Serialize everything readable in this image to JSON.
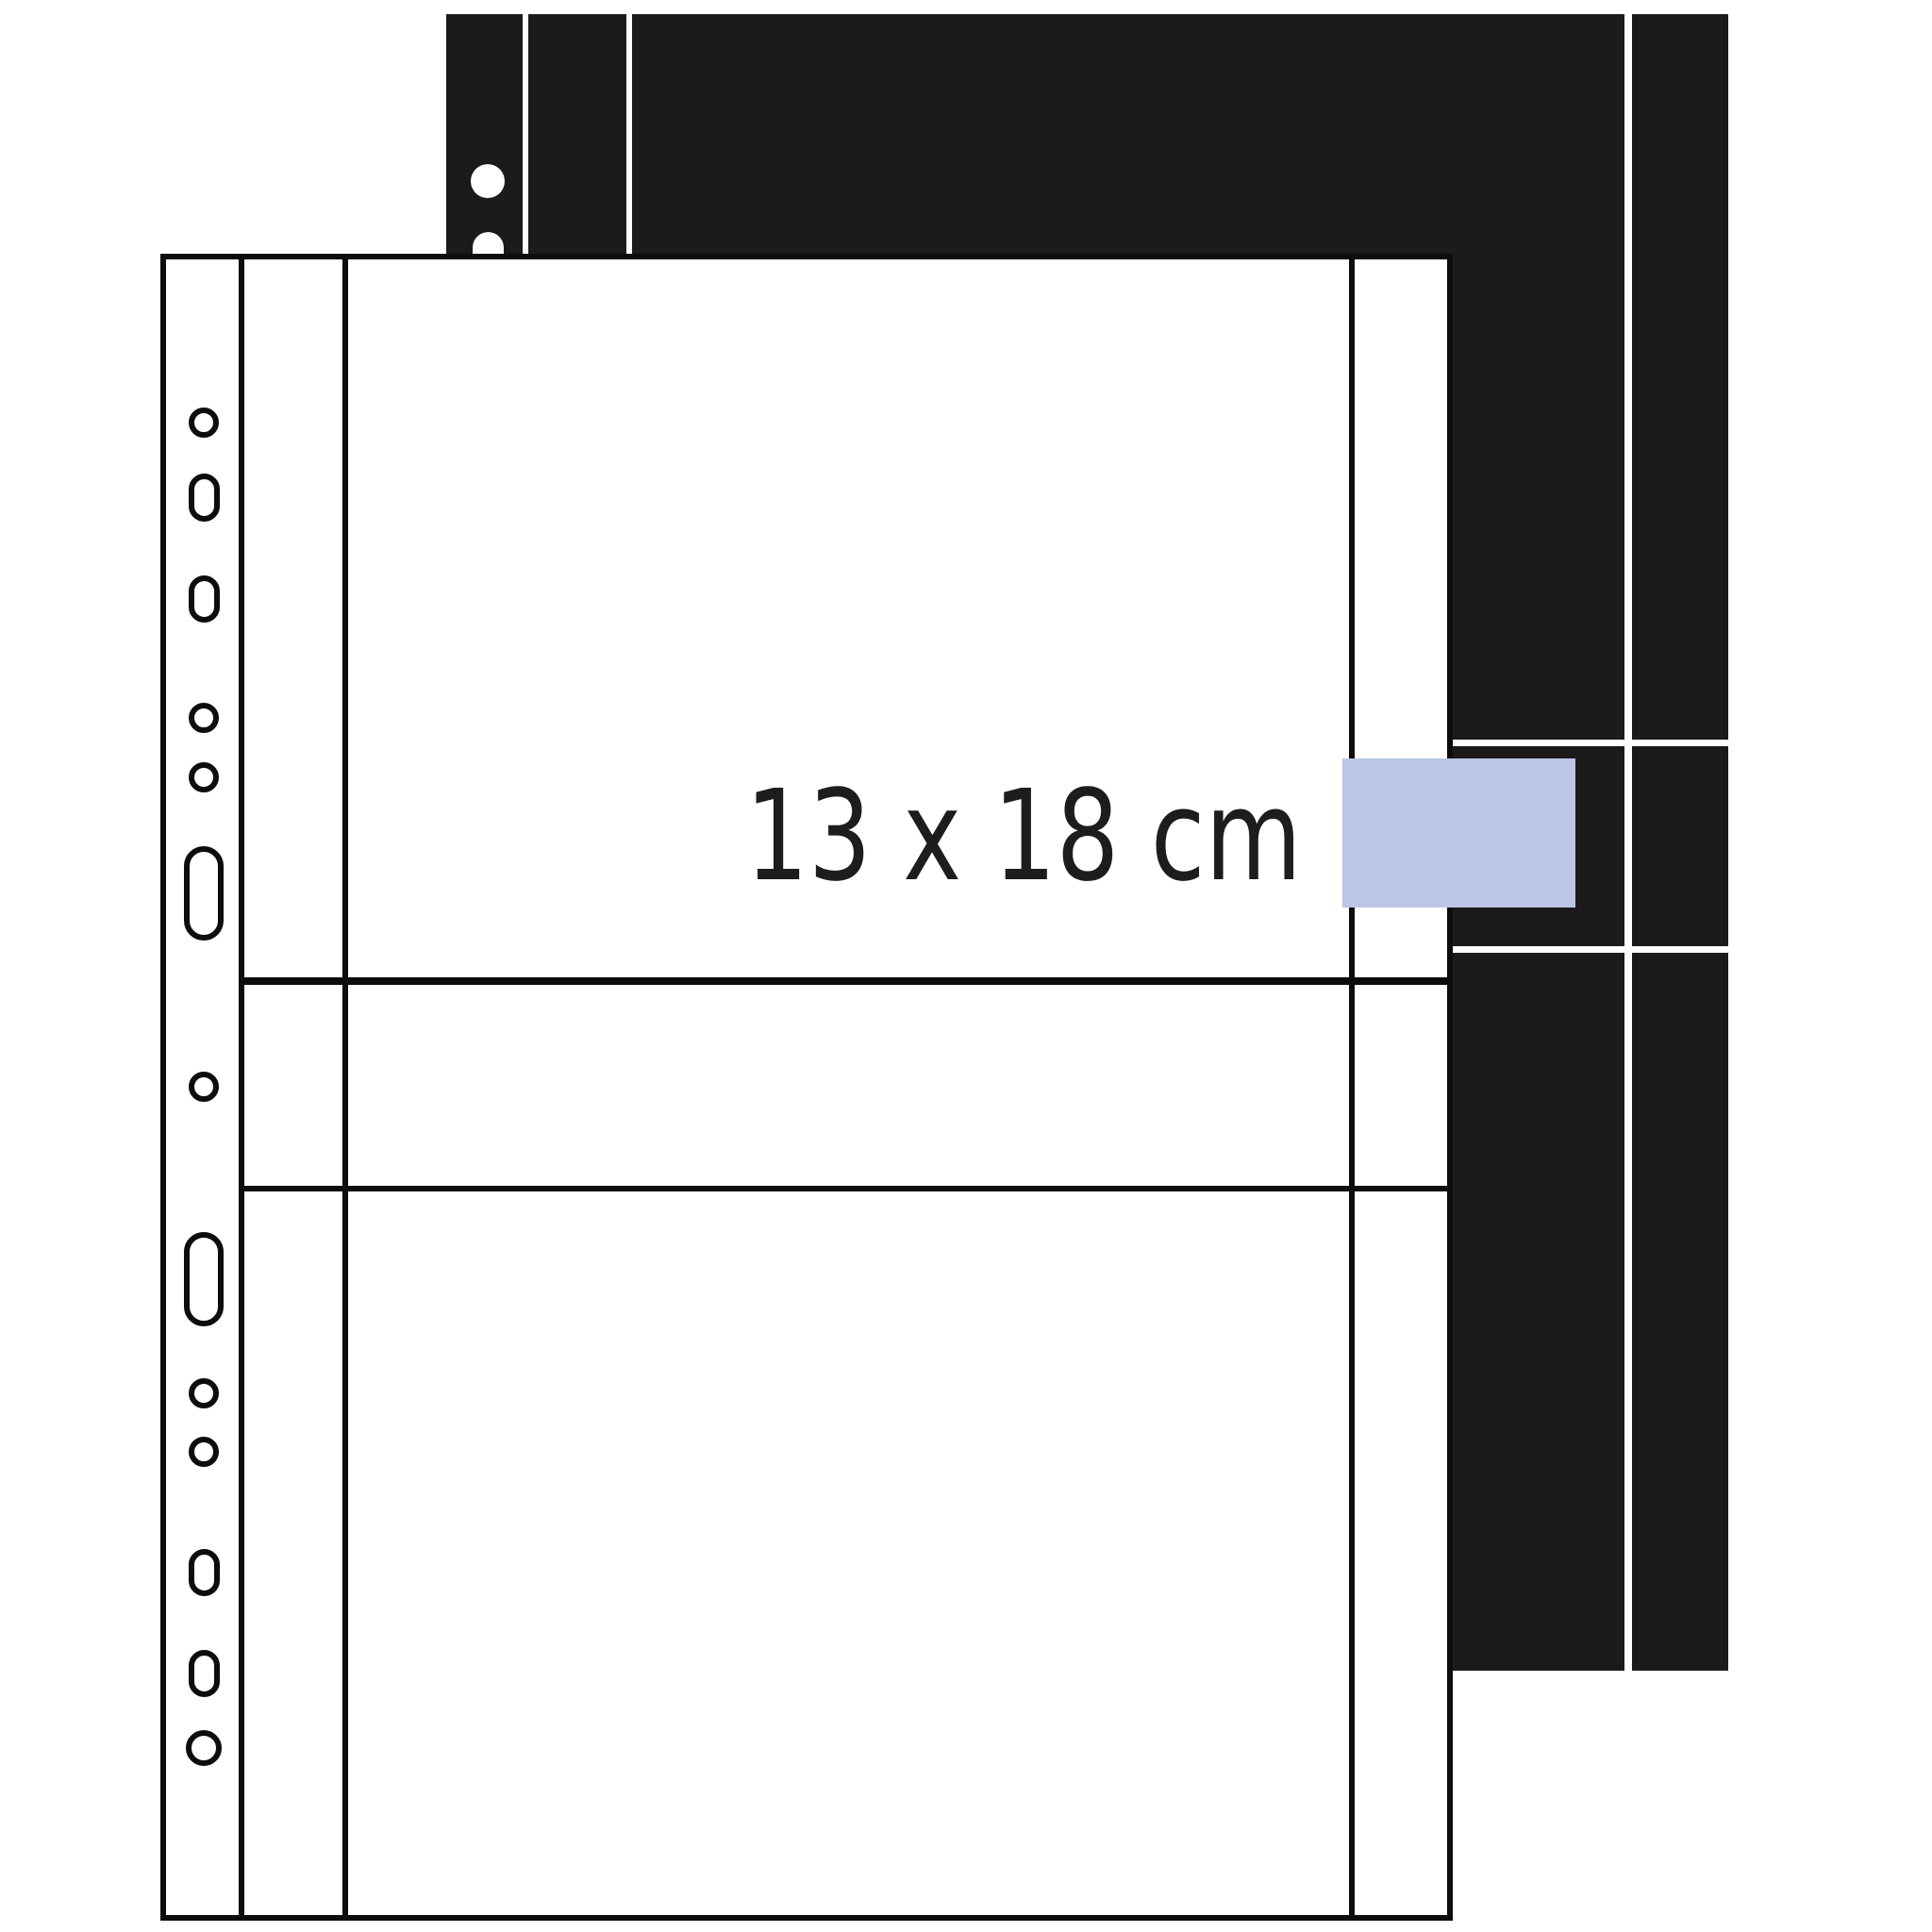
{
  "page": {
    "background_color": "#ffffff",
    "description": "Illustration of two photo pocket sleeve pages for ring binders, white sleeve in front of a black sleeve"
  },
  "label": {
    "size": "13 x 18 cm",
    "color": "#1d1d1d"
  },
  "index_tab": {
    "color": "#bcc5e6"
  },
  "front_sleeve": {
    "name": "white photo pocket sleeve",
    "fill": "#ffffff",
    "line_color": "#0d0d0d",
    "punch_hole_count": 13,
    "pocket_count": 2
  },
  "back_sleeve": {
    "name": "black photo pocket sleeve",
    "fill": "#1b1b1b",
    "line_color": "#ffffff",
    "visible_punch_hole_count": 2
  }
}
